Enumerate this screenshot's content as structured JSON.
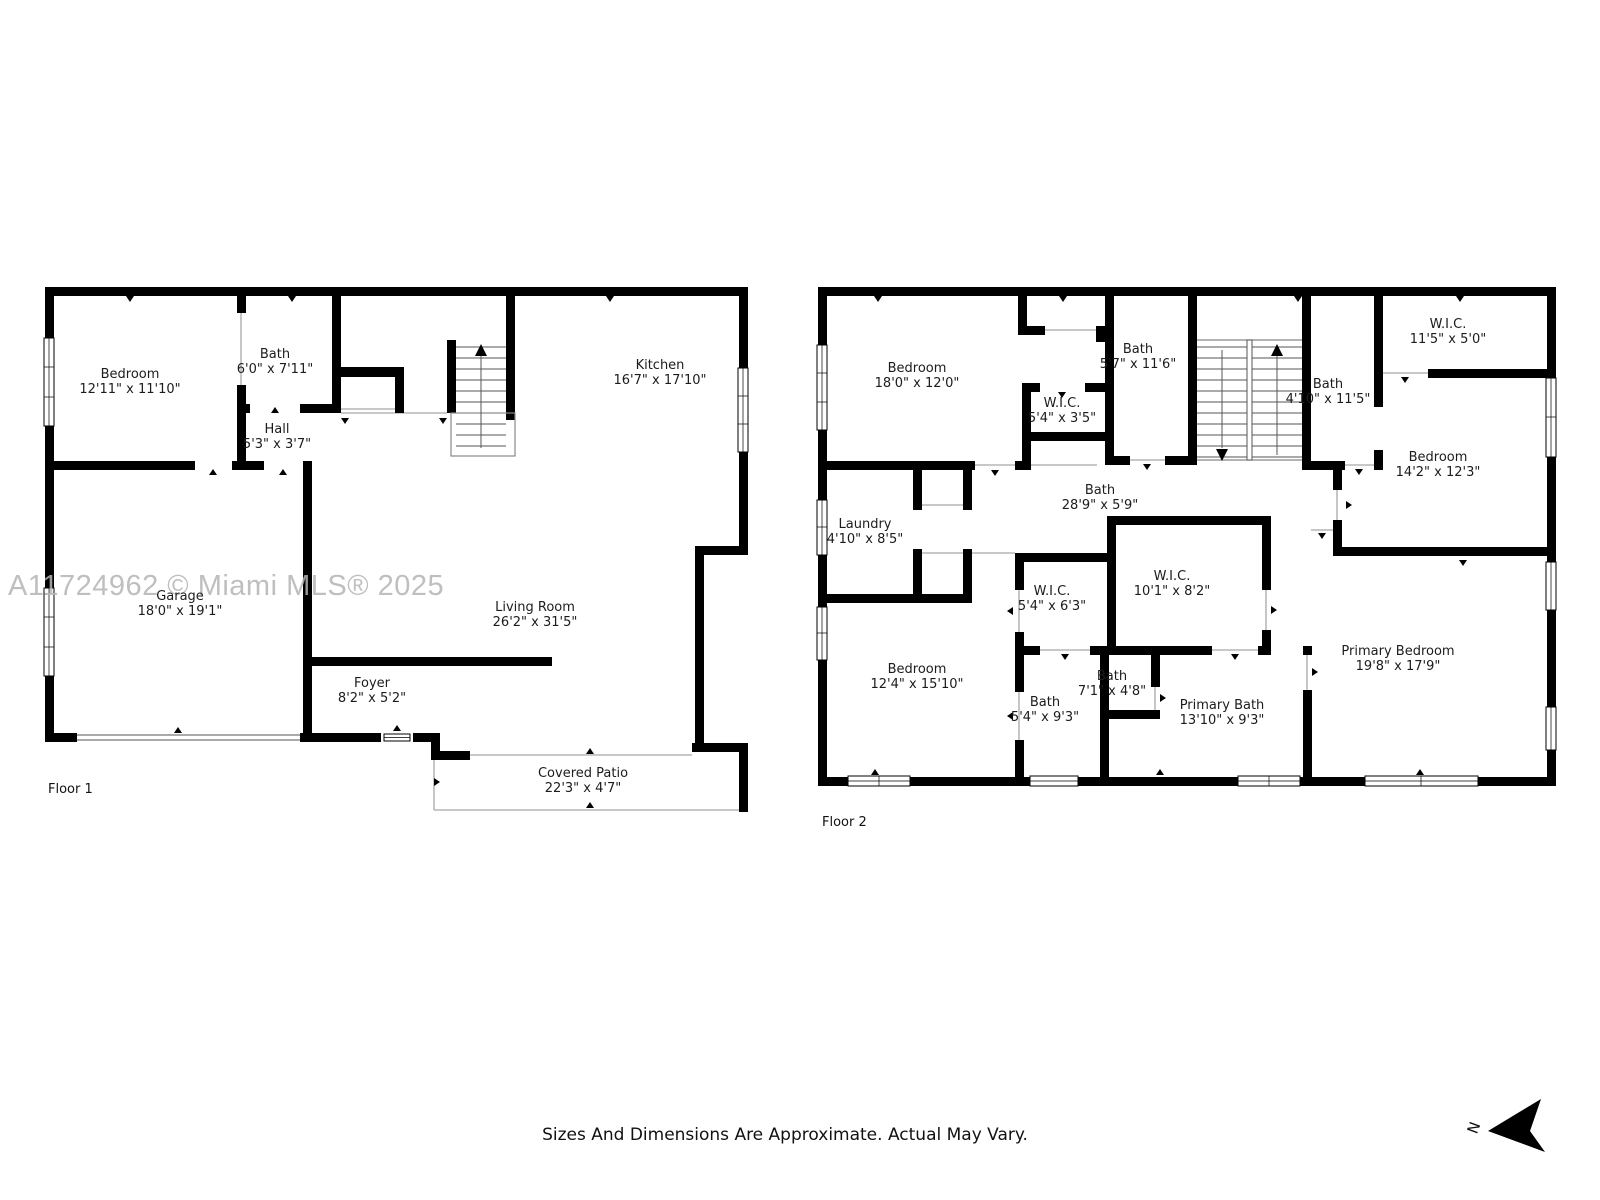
{
  "watermark": "A11724962 © Miami MLS® 2025",
  "disclaimer": "Sizes And Dimensions Are Approximate. Actual May Vary.",
  "compass": {
    "label": "N"
  },
  "floor1": {
    "label": "Floor 1",
    "rooms": {
      "bedroom": {
        "name": "Bedroom",
        "dims": "12'11\" x 11'10\""
      },
      "bath": {
        "name": "Bath",
        "dims": "6'0\" x 7'11\""
      },
      "hall": {
        "name": "Hall",
        "dims": "5'3\" x 3'7\""
      },
      "kitchen": {
        "name": "Kitchen",
        "dims": "16'7\" x 17'10\""
      },
      "garage": {
        "name": "Garage",
        "dims": "18'0\" x 19'1\""
      },
      "living_room": {
        "name": "Living Room",
        "dims": "26'2\" x 31'5\""
      },
      "foyer": {
        "name": "Foyer",
        "dims": "8'2\" x 5'2\""
      },
      "covered_patio": {
        "name": "Covered Patio",
        "dims": "22'3\" x 4'7\""
      }
    }
  },
  "floor2": {
    "label": "Floor 2",
    "rooms": {
      "bedroom_18": {
        "name": "Bedroom",
        "dims": "18'0\" x 12'0\""
      },
      "wic_small": {
        "name": "W.I.C.",
        "dims": "5'4\" x 3'5\""
      },
      "bath_5_7": {
        "name": "Bath",
        "dims": "5'7\" x 11'6\""
      },
      "bath_4_10": {
        "name": "Bath",
        "dims": "4'10\" x 11'5\""
      },
      "wic_11_5": {
        "name": "W.I.C.",
        "dims": "11'5\" x 5'0\""
      },
      "bedroom_14_2": {
        "name": "Bedroom",
        "dims": "14'2\" x 12'3\""
      },
      "laundry": {
        "name": "Laundry",
        "dims": "4'10\" x 8'5\""
      },
      "hall_bath": {
        "name": "Bath",
        "dims": "28'9\" x 5'9\""
      },
      "wic_5_4": {
        "name": "W.I.C.",
        "dims": "5'4\" x 6'3\""
      },
      "wic_10_1": {
        "name": "W.I.C.",
        "dims": "10'1\" x 8'2\""
      },
      "bedroom_12_4": {
        "name": "Bedroom",
        "dims": "12'4\" x 15'10\""
      },
      "bath_5_4": {
        "name": "Bath",
        "dims": "5'4\" x 9'3\""
      },
      "bath_7_1": {
        "name": "Bath",
        "dims": "7'1\" x 4'8\""
      },
      "primary_bath": {
        "name": "Primary Bath",
        "dims": "13'10\" x 9'3\""
      },
      "primary_bedroom": {
        "name": "Primary Bedroom",
        "dims": "19'8\" x 17'9\""
      }
    }
  }
}
